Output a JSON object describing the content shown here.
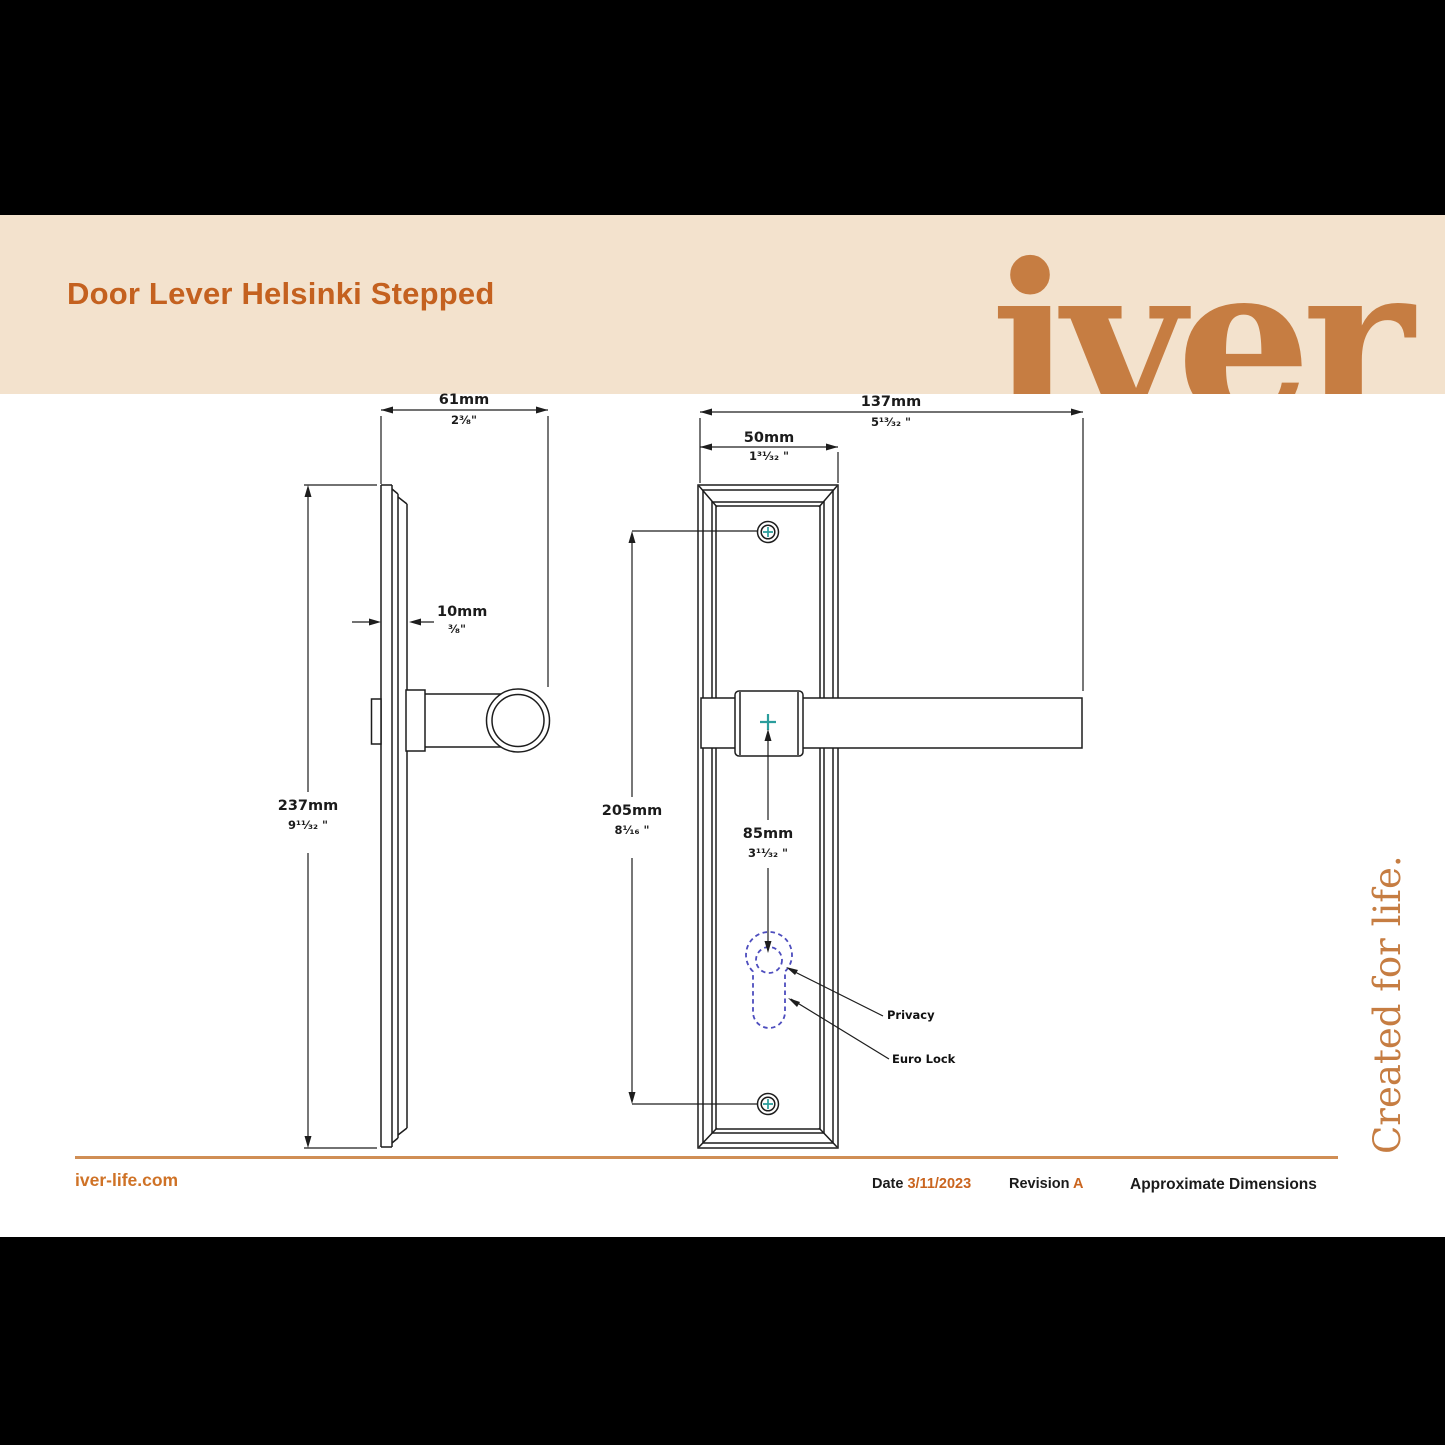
{
  "header": {
    "title": "Door Lever Helsinki Stepped",
    "brand_logo": "iver",
    "tagline": "Created for life."
  },
  "dims": {
    "d61": {
      "mm": "61mm",
      "inch": "2³⁄₈\""
    },
    "d137": {
      "mm": "137mm",
      "inch": "5¹³⁄₃₂ \""
    },
    "d50": {
      "mm": "50mm",
      "inch": "1³¹⁄₃₂ \""
    },
    "d10": {
      "mm": "10mm",
      "inch": "³⁄₈\""
    },
    "d237": {
      "mm": "237mm",
      "inch": "9¹¹⁄₃₂ \""
    },
    "d205": {
      "mm": "205mm",
      "inch": "8¹⁄₁₆ \""
    },
    "d85": {
      "mm": "85mm",
      "inch": "3¹¹⁄₃₂ \""
    }
  },
  "annotations": {
    "privacy": "Privacy",
    "euro_lock": "Euro Lock"
  },
  "footer": {
    "website": "iver-life.com",
    "date_label": "Date",
    "date_value": "3/11/2023",
    "revision_label": "Revision",
    "revision_value": "A",
    "note": "Approximate Dimensions"
  },
  "colors": {
    "band_cream": "#f3e2cd",
    "accent_orange": "#ca651f",
    "logo_orange": "#c67d42",
    "line_black": "#1d1d1d",
    "screw_teal": "#2a9d9c",
    "keyhole_blue": "#4d4dbe"
  }
}
